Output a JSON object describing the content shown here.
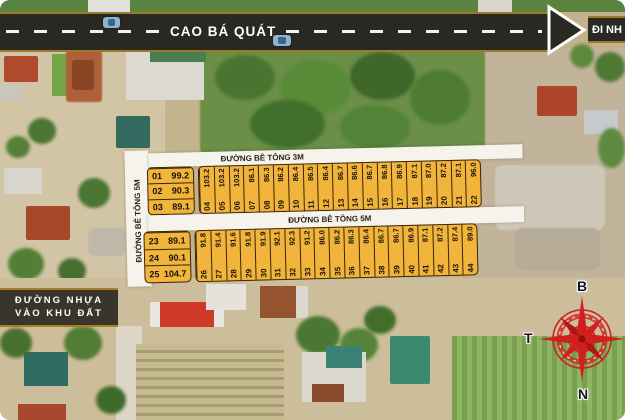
{
  "main_road": {
    "name": "CAO BÁ QUÁT",
    "direction_sign": "ĐI NH"
  },
  "roads": {
    "top_label": "ĐƯỜNG BÊ TÔNG 3M",
    "middle_label": "ĐƯỜNG BÊ TÔNG 5M",
    "left_label": "ĐƯỜNG BÊ TÔNG 5M",
    "access_line1": "ĐƯỜNG NHỰA",
    "access_line2": "VÀO KHU ĐẤT"
  },
  "compass": {
    "north": "B",
    "west": "T",
    "south": "N"
  },
  "plot_table": {
    "row1": {
      "side_plots": [
        {
          "no": "01",
          "area": "99.2"
        },
        {
          "no": "02",
          "area": "90.3"
        },
        {
          "no": "03",
          "area": "89.1"
        }
      ],
      "strip_plots": [
        {
          "no": "04",
          "area": "103.2"
        },
        {
          "no": "05",
          "area": "103.2"
        },
        {
          "no": "06",
          "area": "103.2"
        },
        {
          "no": "07",
          "area": "86.1"
        },
        {
          "no": "08",
          "area": "86.3"
        },
        {
          "no": "09",
          "area": "86.2"
        },
        {
          "no": "10",
          "area": "86.4"
        },
        {
          "no": "11",
          "area": "86.5"
        },
        {
          "no": "12",
          "area": "86.4"
        },
        {
          "no": "13",
          "area": "86.7"
        },
        {
          "no": "14",
          "area": "86.6"
        },
        {
          "no": "15",
          "area": "86.7"
        },
        {
          "no": "16",
          "area": "86.8"
        },
        {
          "no": "17",
          "area": "86.9"
        },
        {
          "no": "18",
          "area": "87.1"
        },
        {
          "no": "19",
          "area": "87.0"
        },
        {
          "no": "20",
          "area": "87.2"
        },
        {
          "no": "21",
          "area": "87.1"
        },
        {
          "no": "22",
          "area": "96.0"
        }
      ]
    },
    "row2": {
      "side_plots": [
        {
          "no": "23",
          "area": "89.1"
        },
        {
          "no": "24",
          "area": "90.1"
        },
        {
          "no": "25",
          "area": "104.7"
        }
      ],
      "strip_plots": [
        {
          "no": "26",
          "area": "91.8"
        },
        {
          "no": "27",
          "area": "91.4"
        },
        {
          "no": "28",
          "area": "91.6"
        },
        {
          "no": "29",
          "area": "91.8"
        },
        {
          "no": "30",
          "area": "91.9"
        },
        {
          "no": "31",
          "area": "92.1"
        },
        {
          "no": "32",
          "area": "92.3"
        },
        {
          "no": "33",
          "area": "91.2"
        },
        {
          "no": "34",
          "area": "86.0"
        },
        {
          "no": "35",
          "area": "86.2"
        },
        {
          "no": "36",
          "area": "86.3"
        },
        {
          "no": "37",
          "area": "86.4"
        },
        {
          "no": "38",
          "area": "86.7"
        },
        {
          "no": "39",
          "area": "86.7"
        },
        {
          "no": "40",
          "area": "86.9"
        },
        {
          "no": "41",
          "area": "87.1"
        },
        {
          "no": "42",
          "area": "87.2"
        },
        {
          "no": "43",
          "area": "87.4"
        },
        {
          "no": "44",
          "area": "89.0"
        }
      ]
    }
  },
  "colors": {
    "plot_fill": "#F2B53B",
    "plot_border": "#3D2308",
    "road_asphalt": "#2A2822",
    "road_gold_line": "#9C7A28",
    "road_white": "#F5F3EC",
    "compass_red": "#D01F1F",
    "label_gold": "#A8801E"
  }
}
